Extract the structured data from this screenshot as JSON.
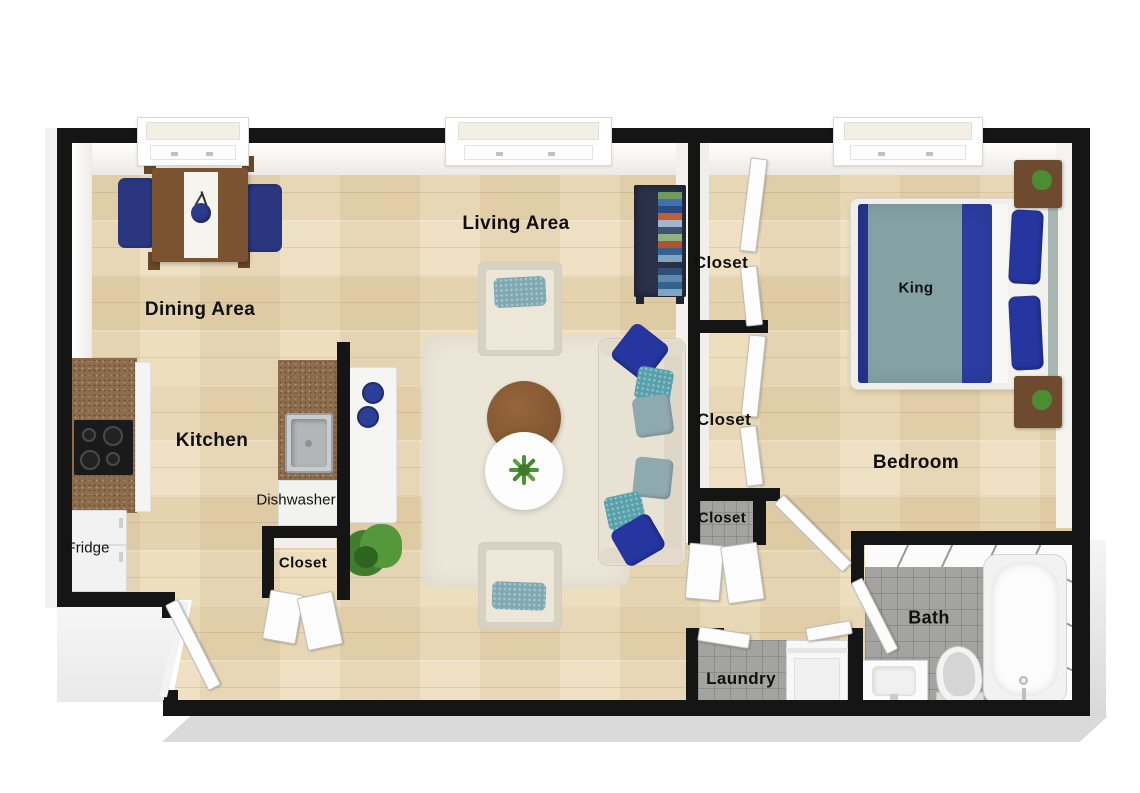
{
  "labels": {
    "living_area": "Living Area",
    "dining_area": "Dining Area",
    "kitchen": "Kitchen",
    "bedroom": "Bedroom",
    "bath": "Bath",
    "laundry": "Laundry",
    "king": "King",
    "fridge": "Fridge",
    "dishwasher": "Dishwasher",
    "closet_hall_upper": "Closet",
    "closet_hall_middle": "Closet",
    "closet_hall_lower": "Closet",
    "closet_kitchen": "Closet"
  },
  "colors": {
    "wall": "#151515",
    "wood_floor": "#e9d8b6",
    "accent_navy": "#2636a0",
    "accent_teal": "#7ca8b0",
    "sofa_cream": "#e8e2d4",
    "granite_brown": "#8d6d4c",
    "tile_gray": "#a3a3a1",
    "table_brown": "#7b5331",
    "plant_green": "#4c8c33"
  }
}
